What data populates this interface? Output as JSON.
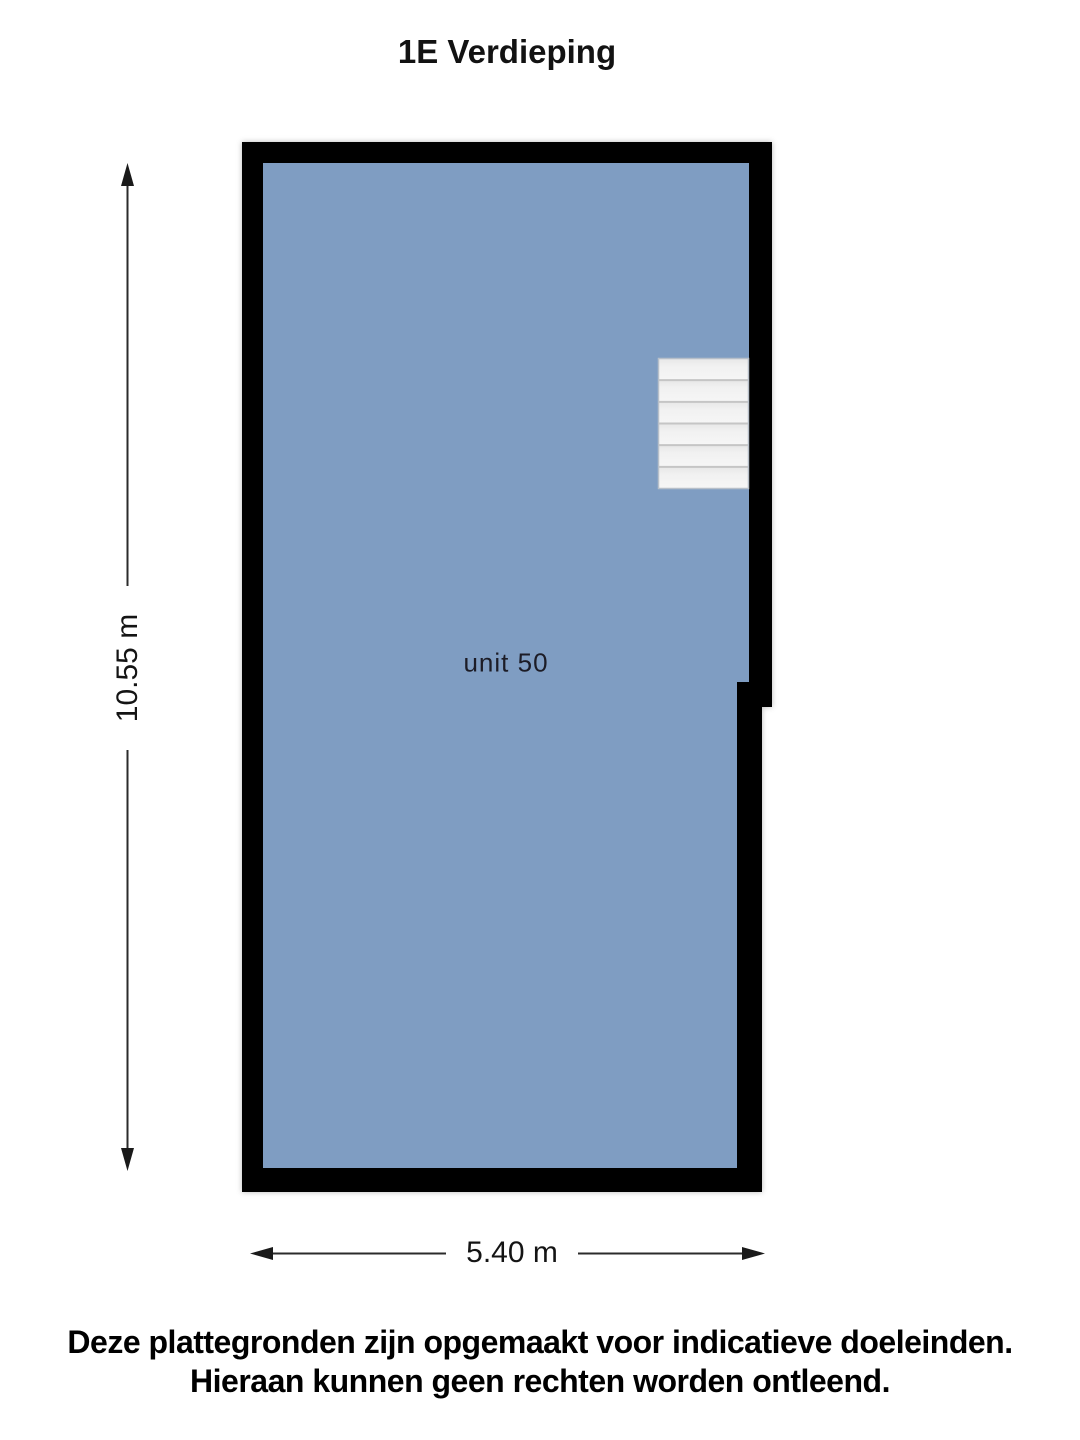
{
  "title": "1E Verdieping",
  "floor_plan": {
    "room_label": "unit 50",
    "dimensions": {
      "height_label": "10.55 m",
      "width_label": "5.40 m"
    },
    "stairs_steps": 6,
    "colors": {
      "room_fill": "#7f9dc2",
      "wall": "#000000",
      "stairs_fill_top": "#e7e7e7",
      "stairs_fill_bottom": "#f6f6f6",
      "stairs_separator": "#c5c5c5"
    }
  },
  "disclaimer": {
    "line1": "Deze plattegronden zijn opgemaakt voor indicatieve doeleinden.",
    "line2": "Hieraan kunnen geen rechten worden ontleend."
  }
}
